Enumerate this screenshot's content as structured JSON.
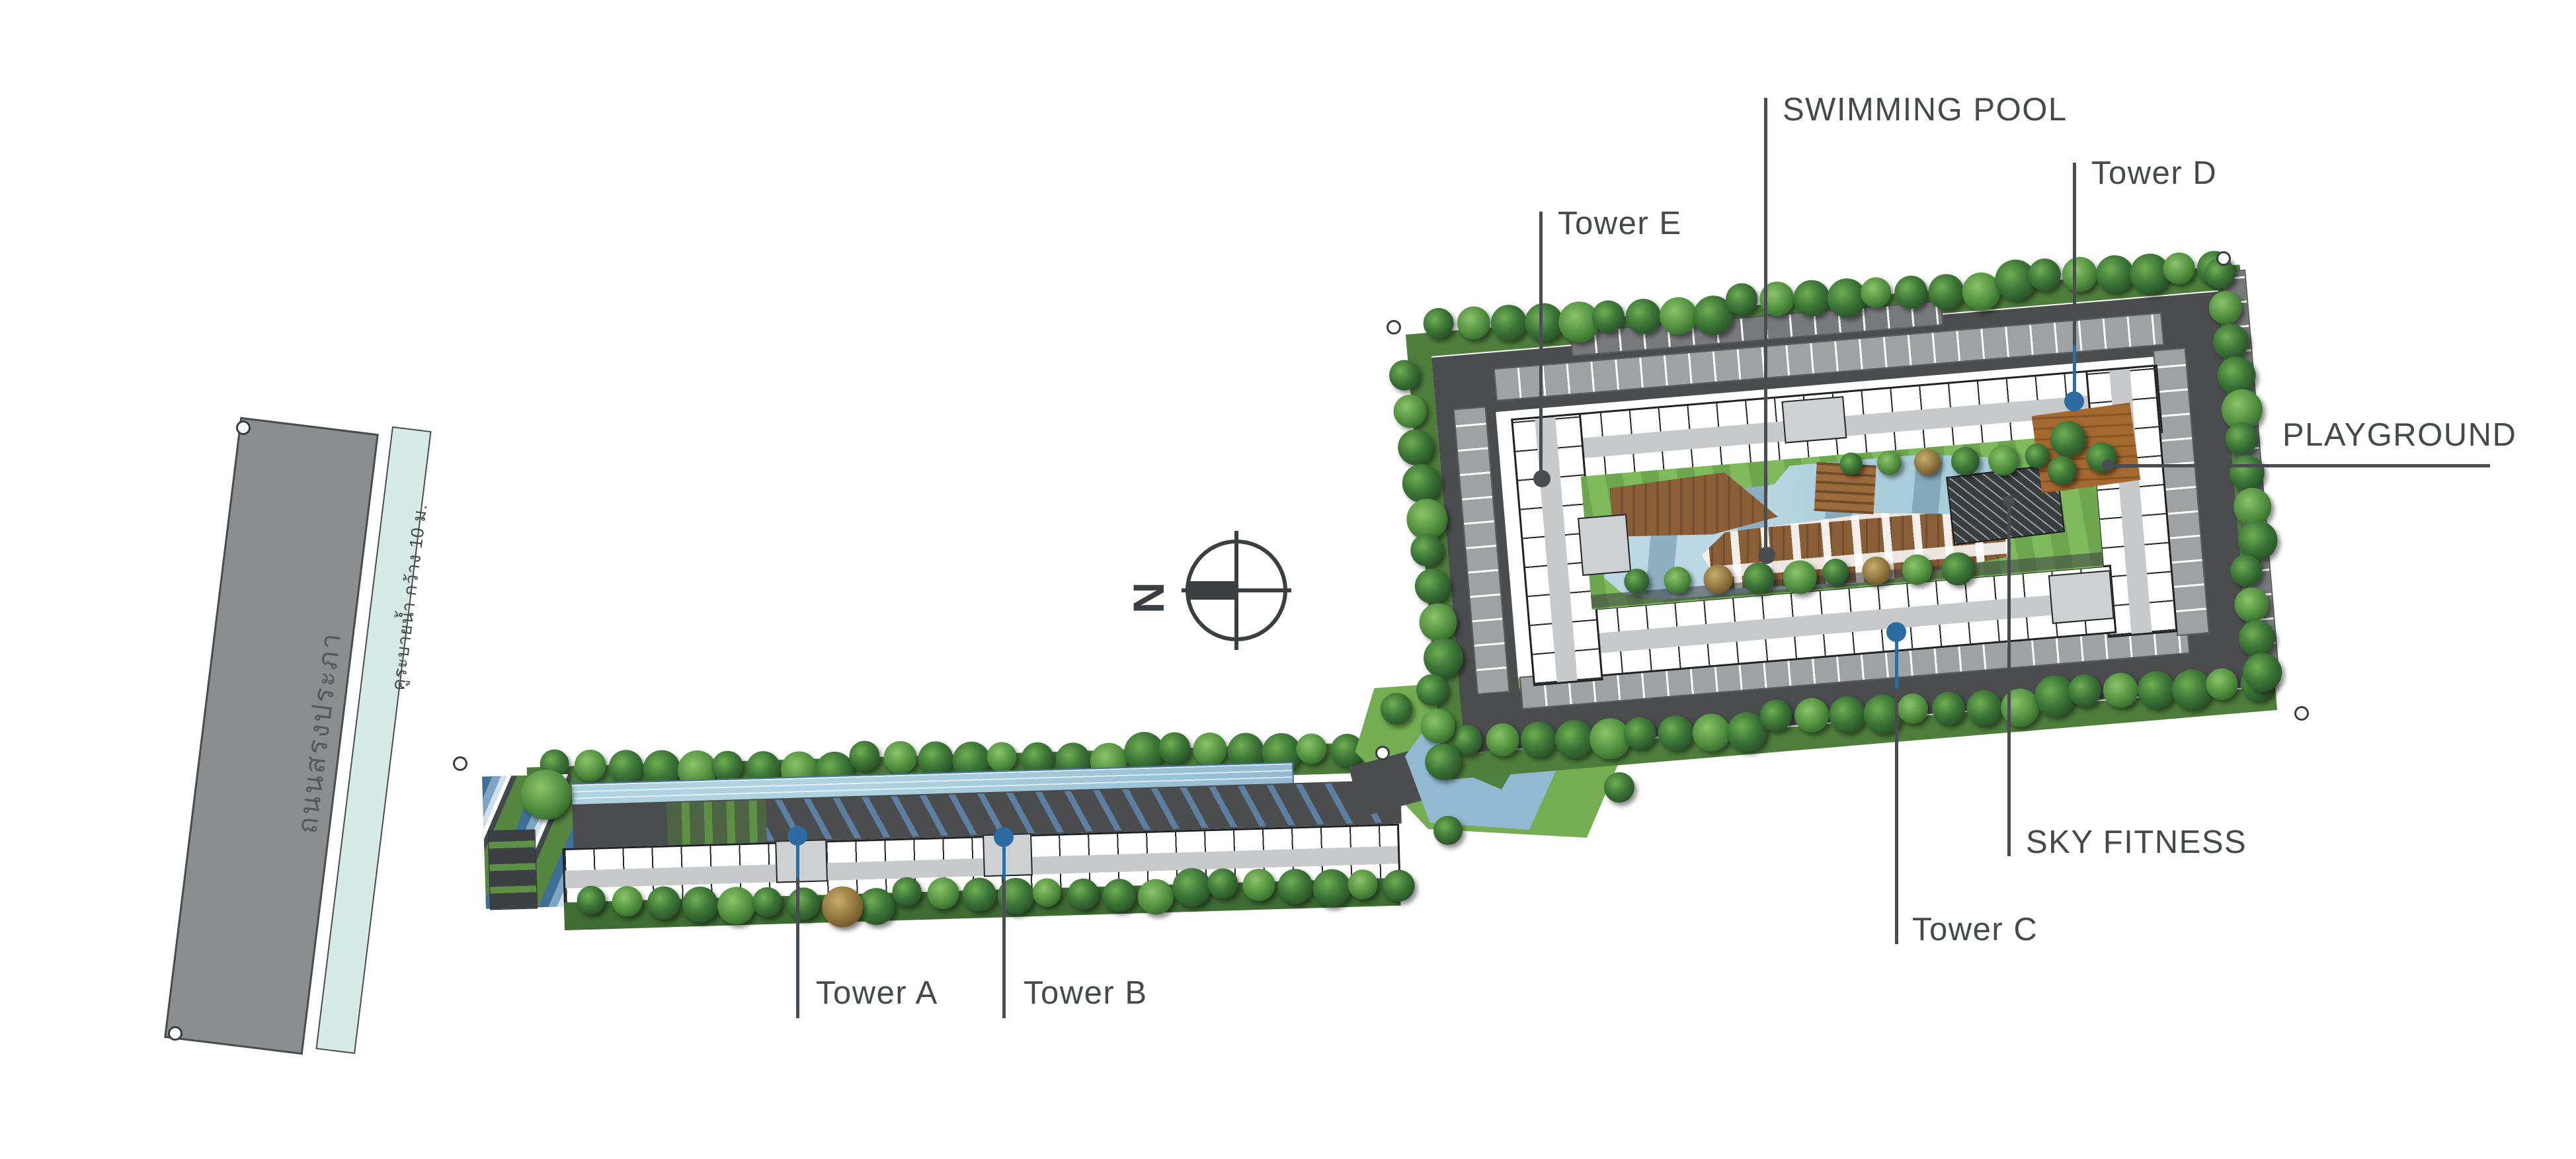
{
  "plan_title": "condominium-master-plan",
  "compass": {
    "north_label": "N"
  },
  "roads": {
    "main_road_label": "ถนนสรงประภา",
    "canal_label": "คูระบายน้ำ กว้าง 10 ม."
  },
  "annotations": {
    "swimming_pool": "SWIMMING POOL",
    "tower_e": "Tower E",
    "tower_d": "Tower D",
    "playground": "PLAYGROUND",
    "sky_fitness": "SKY FITNESS",
    "tower_c": "Tower C",
    "tower_a": "Tower A",
    "tower_b": "Tower B"
  },
  "colors": {
    "ink": "#46494b",
    "leader": "#4a4d4f",
    "blue": "#2d6ca0",
    "road-gray": "#8b8d8f",
    "canal-mint": "#d7ebe6",
    "asphalt": "#4a4c4e",
    "parking": "#9fa2a4",
    "lawn": "#6da64f",
    "pool-blue": "#a8ccda",
    "pond-blue": "#92b8d2",
    "deck-brown": "#8a5f38",
    "playground-brown": "#a4692f",
    "fitness-roof": "#3a3d40"
  }
}
